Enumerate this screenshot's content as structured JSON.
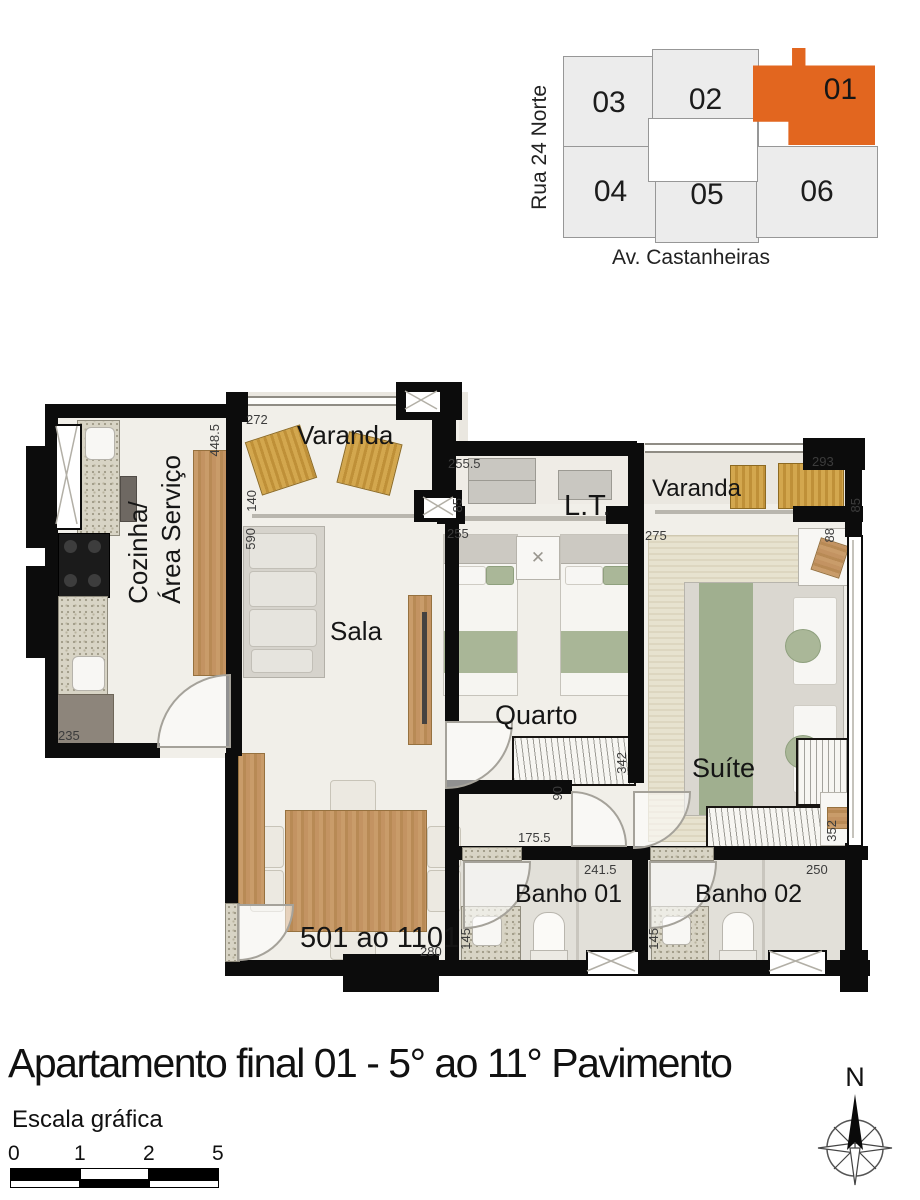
{
  "key_plan": {
    "street_left": "Rua 24 Norte",
    "street_bottom": "Av. Castanheiras",
    "highlight_color": "#E2661F",
    "units": [
      {
        "label": "03",
        "highlighted": false
      },
      {
        "label": "02",
        "highlighted": false
      },
      {
        "label": "01",
        "highlighted": true
      },
      {
        "label": "04",
        "highlighted": false
      },
      {
        "label": "05",
        "highlighted": false
      },
      {
        "label": "06",
        "highlighted": false
      }
    ]
  },
  "plan": {
    "rooms": {
      "varanda1": "Varanda",
      "cozinha_line1": "Cozinha/",
      "cozinha_line2": "Área Serviço",
      "sala": "Sala",
      "lt": "L.T.",
      "varanda2": "Varanda",
      "quarto": "Quarto",
      "suite": "Suíte",
      "banho1": "Banho 01",
      "banho2": "Banho 02",
      "unit_range": "501 ao 1101"
    },
    "dims": {
      "varanda1_width": "272",
      "kitchen_wall": "448.5",
      "varanda1_opening": "140",
      "sala_length": "590",
      "lt_width": "255.5",
      "lt_depth": "85",
      "quarto_width": "255",
      "suite_width": "275",
      "varanda2_width": "293",
      "varanda2_depth": "85",
      "suite_desk": "88",
      "quarto_length": "342",
      "hall_door": "90",
      "hall_length": "175.5",
      "banho1_width": "241.5",
      "banho1_depth": "145",
      "banho2_width": "250",
      "suite_length": "352",
      "banho2_depth": "145",
      "cozinha_width": "235",
      "sala_width": "280"
    }
  },
  "title": "Apartamento final 01 - 5° ao 11° Pavimento",
  "scale_bar": {
    "label": "Escala gráfica",
    "ticks": [
      "0",
      "1",
      "2",
      "5"
    ]
  },
  "compass": {
    "north_label": "N"
  }
}
